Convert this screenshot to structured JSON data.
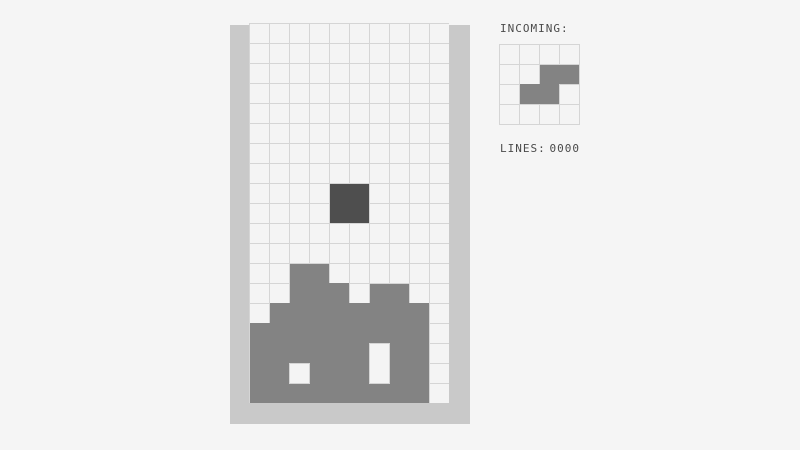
{
  "palette": {
    "background": "#f5f5f5",
    "wall": "#c9c9c9",
    "cell": "#f4f4f4",
    "grid_line": "#d5d5d5",
    "stack": "#838383",
    "active_piece": "#4e4e4e",
    "text": "#4a4a4a"
  },
  "board": {
    "cols": 10,
    "rows": 19,
    "cell_px": 20,
    "stack_rects": [
      {
        "col": 2,
        "row": 12,
        "w": 2,
        "h": 1,
        "flush_top": false
      },
      {
        "col": 2,
        "row": 13,
        "w": 3,
        "h": 1,
        "flush_top": true
      },
      {
        "col": 6,
        "row": 13,
        "w": 2,
        "h": 1,
        "flush_top": false
      },
      {
        "col": 1,
        "row": 14,
        "w": 8,
        "h": 1,
        "flush_top": true
      },
      {
        "col": 0,
        "row": 15,
        "w": 9,
        "h": 4,
        "flush_top": true
      }
    ],
    "holes": [
      {
        "col": 2,
        "row": 17,
        "w": 1,
        "h": 1
      },
      {
        "col": 6,
        "row": 16,
        "w": 1,
        "h": 2
      }
    ],
    "active_piece": {
      "name": "O-piece",
      "rects": [
        {
          "col": 4,
          "row": 8,
          "w": 2,
          "h": 2,
          "flush_top": false
        }
      ]
    }
  },
  "side_panel": {
    "incoming_label": "INCOMING:",
    "preview": {
      "cols": 4,
      "rows": 4,
      "cell_px": 20,
      "piece": "S-piece",
      "rects": [
        {
          "col": 2,
          "row": 1,
          "w": 2,
          "h": 1,
          "flush_top": false
        },
        {
          "col": 1,
          "row": 2,
          "w": 2,
          "h": 1,
          "flush_top": true
        }
      ]
    },
    "lines_label": "LINES:",
    "lines_value": "0000"
  }
}
